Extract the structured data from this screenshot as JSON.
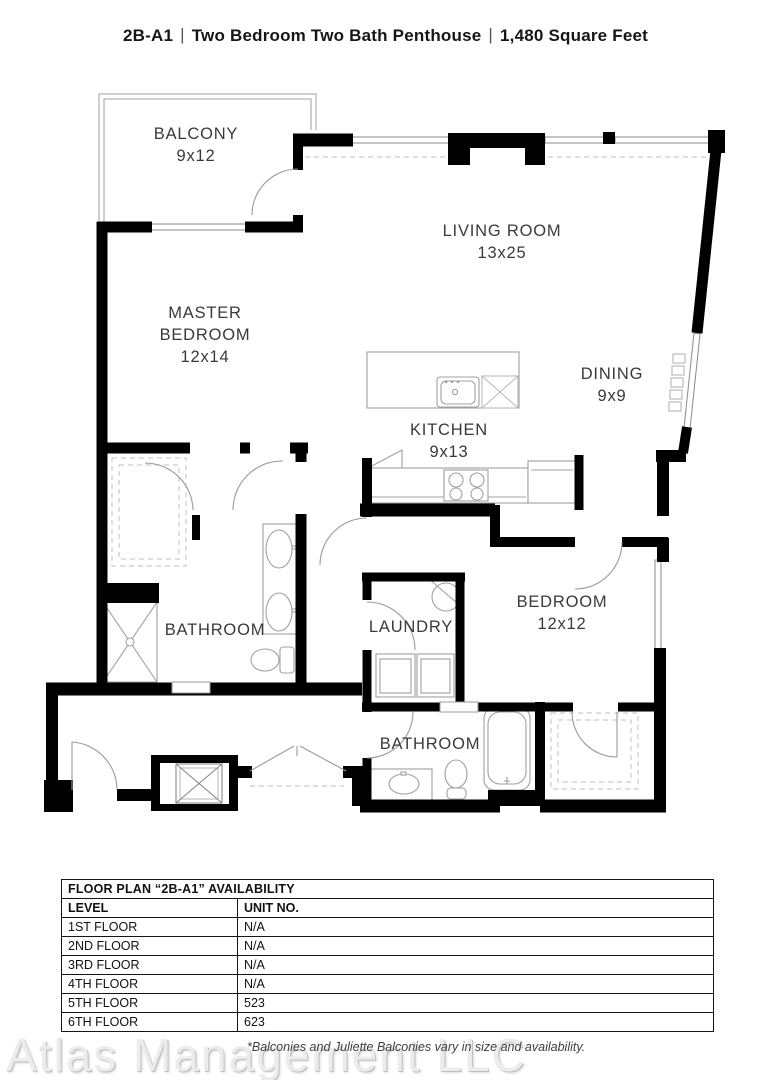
{
  "header": {
    "unit": "2B-A1",
    "separator": "|",
    "name": "Two Bedroom Two Bath Penthouse",
    "size": "1,480 Square Feet"
  },
  "plan": {
    "rooms": {
      "balcony": {
        "label": "BALCONY",
        "dims": "9x12"
      },
      "living_room": {
        "label": "LIVING ROOM",
        "dims": "13x25"
      },
      "master_bedroom": {
        "label_line1": "MASTER",
        "label_line2": "BEDROOM",
        "dims": "12x14"
      },
      "dining": {
        "label": "DINING",
        "dims": "9x9"
      },
      "kitchen": {
        "label": "KITCHEN",
        "dims": "9x13"
      },
      "master_bathroom": {
        "label": "BATHROOM"
      },
      "laundry": {
        "label": "LAUNDRY"
      },
      "bedroom": {
        "label": "BEDROOM",
        "dims": "12x12"
      },
      "bathroom2": {
        "label": "BATHROOM"
      }
    },
    "colors": {
      "wall": "#000000",
      "fixture_line": "#a0a0a0",
      "label": "#3a3a3a"
    }
  },
  "availability_table": {
    "title": "FLOOR PLAN “2B-A1” AVAILABILITY",
    "columns": [
      "LEVEL",
      "UNIT NO."
    ],
    "rows": [
      [
        "1ST FLOOR",
        "N/A"
      ],
      [
        "2ND FLOOR",
        "N/A"
      ],
      [
        "3RD FLOOR",
        "N/A"
      ],
      [
        "4TH FLOOR",
        "N/A"
      ],
      [
        "5TH FLOOR",
        "523"
      ],
      [
        "6TH FLOOR",
        "623"
      ]
    ]
  },
  "footer": {
    "watermark": "Atlas Management LLC",
    "disclaimer": "*Balconies and Juliette Balconies vary in size and availability."
  }
}
